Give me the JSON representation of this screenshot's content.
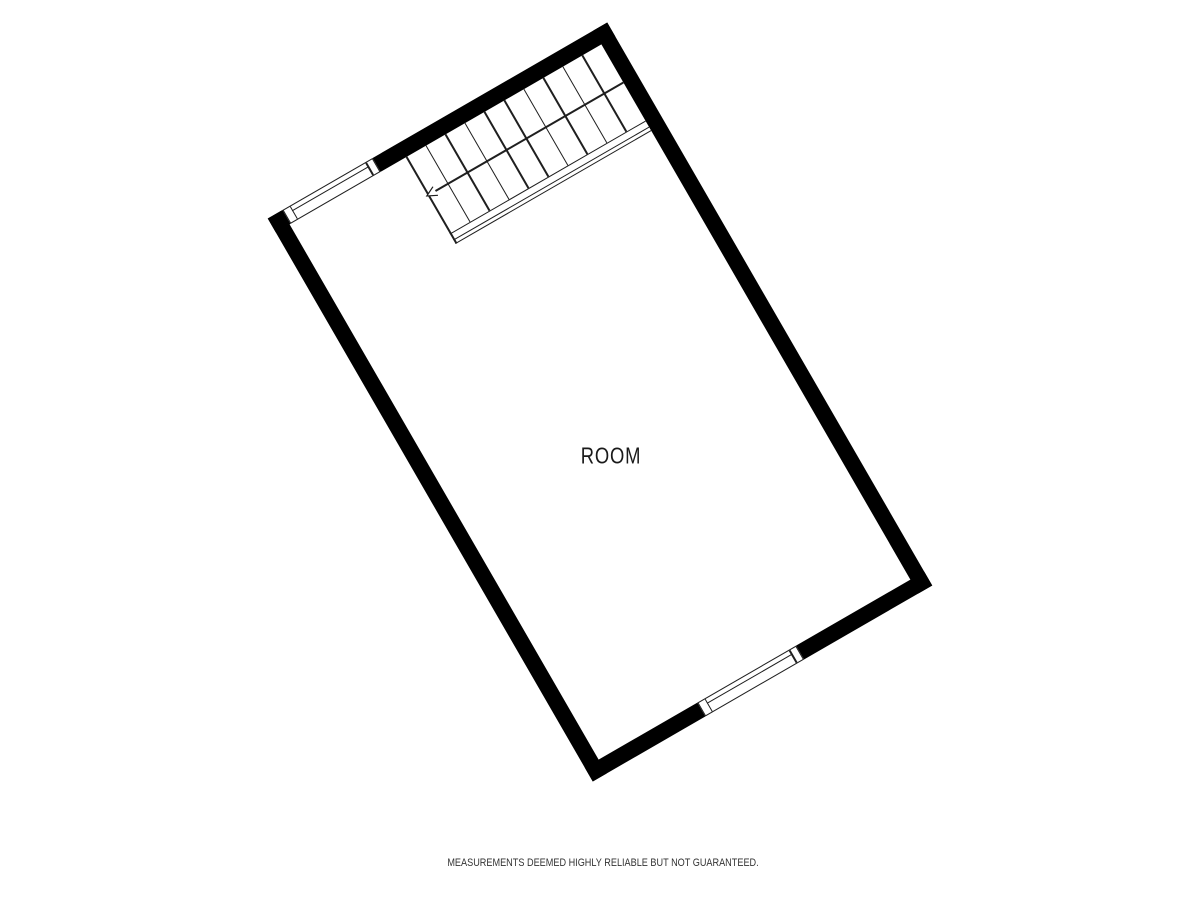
{
  "floorplan": {
    "room": {
      "label": "ROOM"
    },
    "walls": {
      "color": "#000000",
      "thickness_px": 16,
      "rotation_deg": -30
    },
    "line_color": "#1f1f1f",
    "windows": {
      "count": 2,
      "positions": [
        "upper-left-wall",
        "lower-right-wall"
      ]
    },
    "staircase": {
      "tread_count": 10,
      "tread_spacing_px": 22.6,
      "arrow_icon": "open-arrowhead-down-left",
      "arrow_direction": "down-left"
    },
    "disclaimer": "MEASUREMENTS DEEMED HIGHLY RELIABLE BUT NOT GUARANTEED."
  }
}
